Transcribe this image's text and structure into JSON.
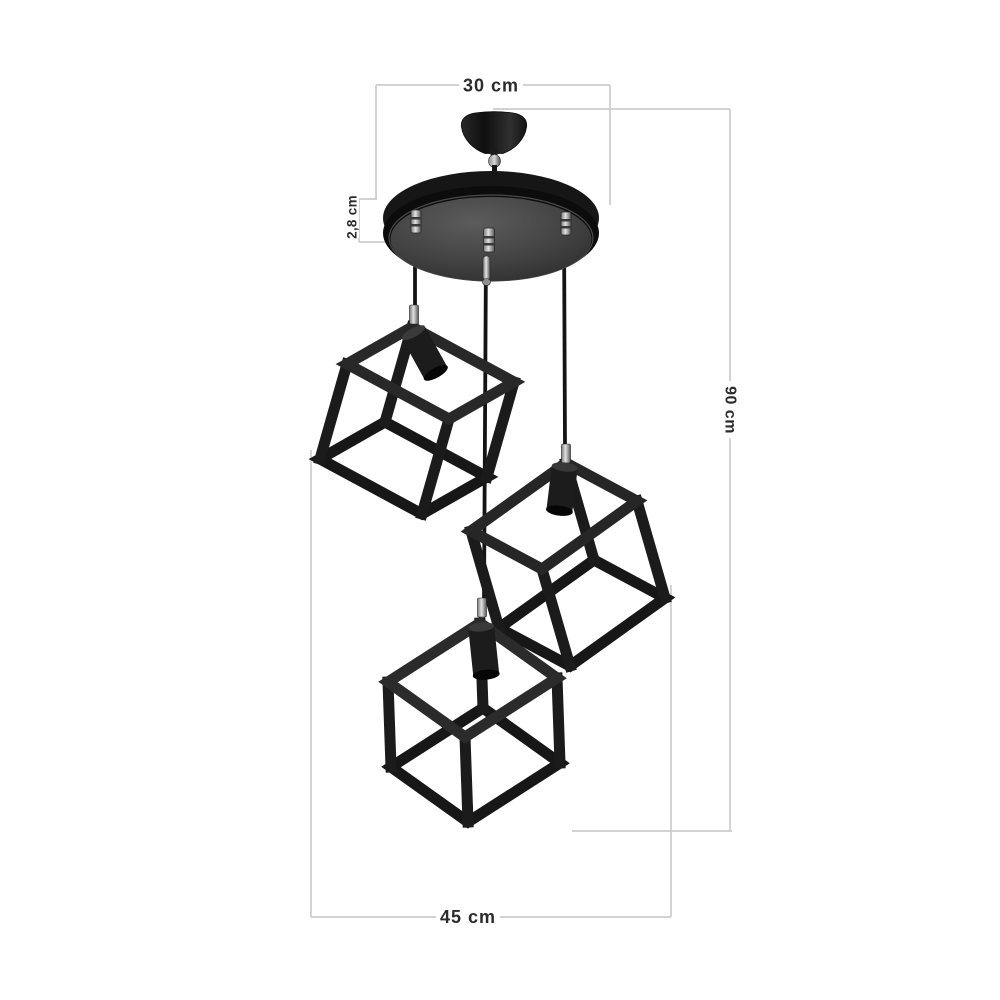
{
  "style": {
    "background": "#ffffff",
    "dimension_line_color": "#cccccc",
    "label_color": "#2b2b2b",
    "fixture_black": "#181818",
    "plate_face_gray": "#4a4a4a",
    "chrome": "#cfcfcf"
  },
  "dimensions": {
    "canopy_width": {
      "label": "30 cm"
    },
    "plate_thickness": {
      "label": "2,8 cm"
    },
    "drop_height": {
      "label": "90 cm"
    },
    "overall_width": {
      "label": "45 cm"
    }
  },
  "figure": {
    "parts": {
      "canopy": "ceiling-canopy",
      "plate": "round-mounting-plate",
      "cables": "suspension-cables",
      "shades": "cube-cage-shades",
      "sockets": "lamp-sockets"
    }
  }
}
